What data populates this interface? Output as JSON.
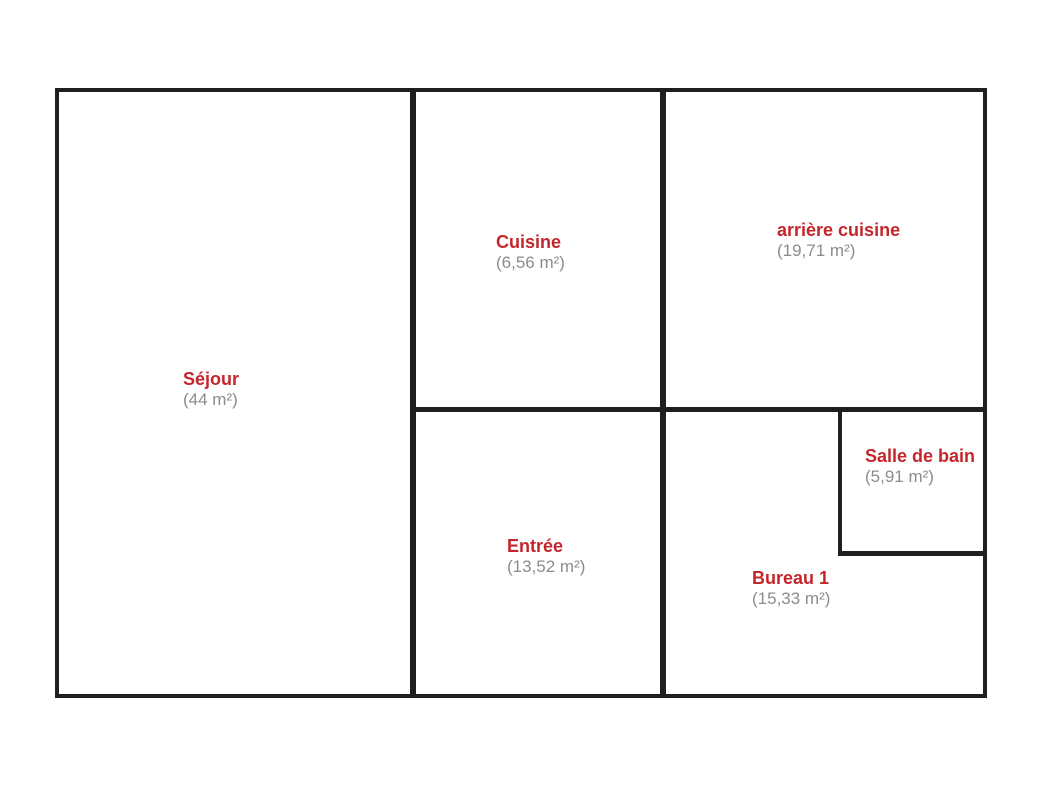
{
  "plan": {
    "title": "Floor plan with room areas",
    "rooms": [
      {
        "id": "sejour",
        "name": "Séjour",
        "area": "(44 m²)"
      },
      {
        "id": "cuisine",
        "name": "Cuisine",
        "area": "(6,56 m²)"
      },
      {
        "id": "arriere-cuisine",
        "name": "arrière cuisine",
        "area": "(19,71 m²)"
      },
      {
        "id": "entree",
        "name": "Entrée",
        "area": "(13,52 m²)"
      },
      {
        "id": "bureau-1",
        "name": "Bureau 1",
        "area": "(15,33 m²)"
      },
      {
        "id": "salle-de-bain",
        "name": "Salle de bain",
        "area": "(5,91 m²)"
      }
    ],
    "colors": {
      "room_name": "#c4262b",
      "room_area": "#8c8c8c",
      "wall": "#1f1f1f",
      "background": "#ffffff"
    }
  }
}
